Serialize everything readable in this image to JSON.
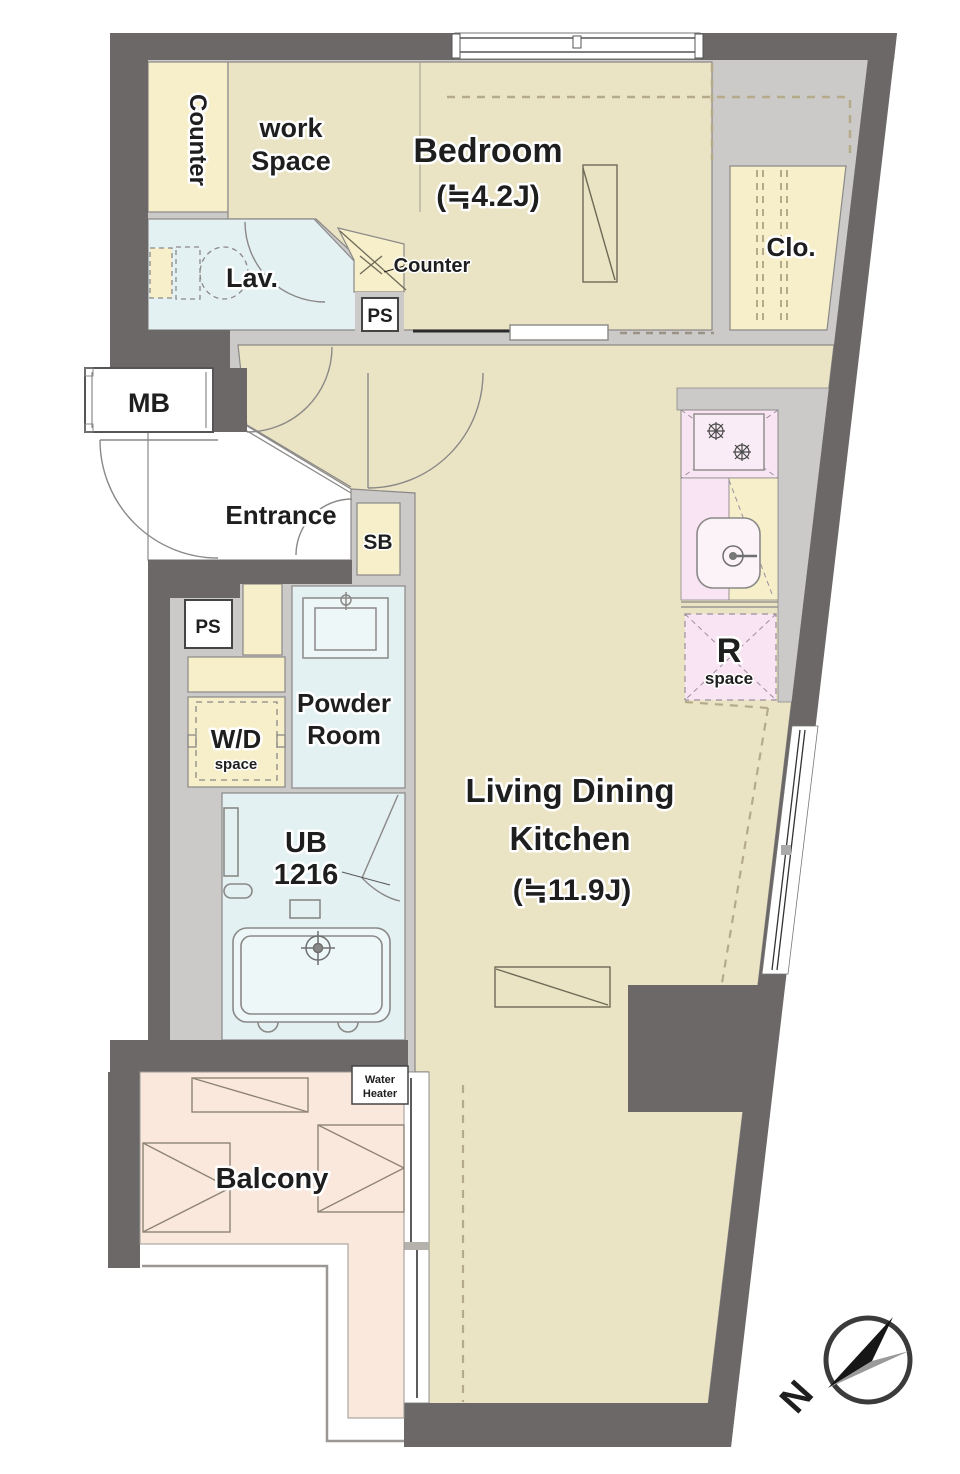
{
  "plan_title": "apartment-floor-plan",
  "rooms": {
    "bedroom": {
      "name": "Bedroom",
      "area": "(≒4.2J)"
    },
    "work_space": {
      "line1": "work",
      "line2": "Space"
    },
    "closet": {
      "name": "Clo."
    },
    "lavatory": {
      "name": "Lav."
    },
    "entrance": {
      "name": "Entrance"
    },
    "powder_room": {
      "line1": "Powder",
      "line2": "Room"
    },
    "unit_bath": {
      "line1": "UB",
      "line2": "1216"
    },
    "ldk": {
      "line1": "Living Dining",
      "line2": "Kitchen",
      "area": "(≒11.9J)"
    },
    "balcony": {
      "name": "Balcony"
    }
  },
  "fixtures": {
    "counter_top": "Counter",
    "counter_corner": "Counter",
    "meter_box": "MB",
    "shoe_box": "SB",
    "pipe_space_upper": "PS",
    "pipe_space_lower": "PS",
    "washer_dryer": {
      "line1": "W/D",
      "line2": "space"
    },
    "refrigerator": {
      "line1": "R",
      "line2": "space"
    },
    "water_heater": {
      "line1": "Water",
      "line2": "Heater"
    }
  },
  "compass": {
    "north": "N"
  },
  "colors": {
    "wall_dark": "#6b6867",
    "wall_light": "#cccac8",
    "floor_tan": "#eae3c4",
    "accent_yellow": "#f6efca",
    "water_blue": "#e3f1f3",
    "kitchen_pink": "#f8e4f2",
    "balcony_peach": "#fbe8dc",
    "outline": "#8b8987",
    "text": "#1e1e1e"
  }
}
